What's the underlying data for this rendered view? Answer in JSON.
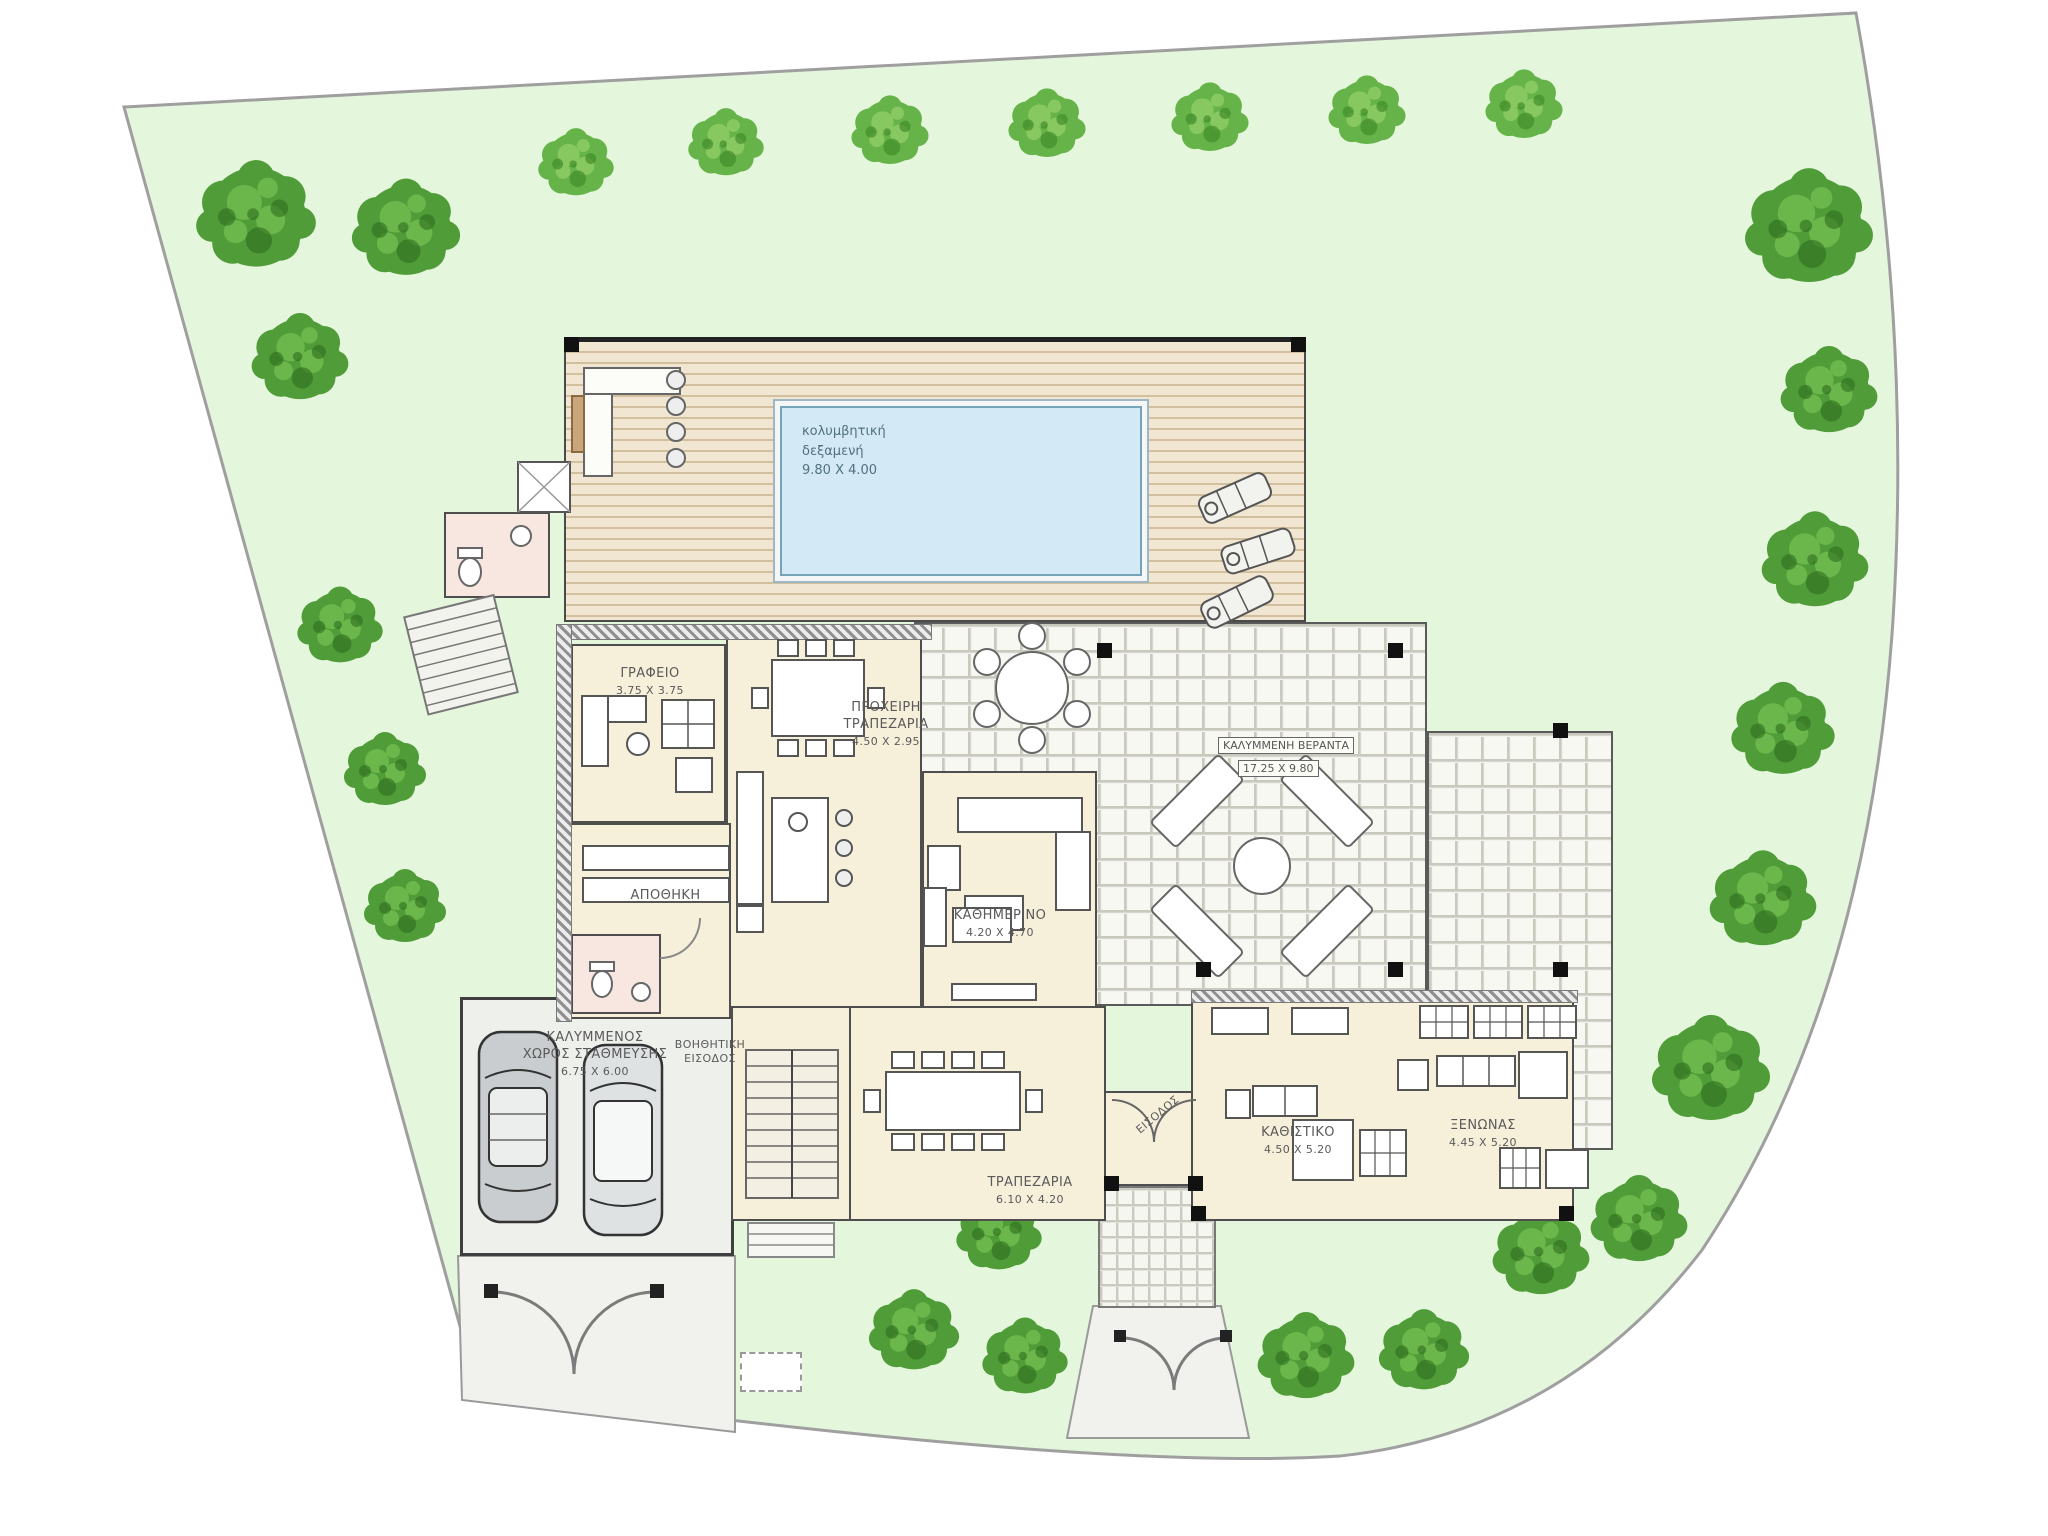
{
  "drawing": {
    "type": "villa-site-plan",
    "style": "architectural top view with garden"
  },
  "colors": {
    "lawn": "#e4f6dc",
    "boundary": "#9f9f9f",
    "deck_wood": "#f0e6d2",
    "deck_plank_line": "#d2bf9e",
    "pool_water": "#d3eaf6",
    "pool_edge": "#76a3b8",
    "veranda_tile": "#f8f8f3",
    "tile_grout": "#c9c9bd",
    "floor_cream": "#f6efda",
    "wall_gray": "#4e4e4e",
    "wet_room_pink": "#f7e7e0",
    "garage_gray": "#eef0ec",
    "tree_green_dark": "#4f9c38",
    "tree_green_light": "#5fae43",
    "label_text": "#5a5a5a"
  },
  "labels": {
    "pool": {
      "line1": "κολυμβητική",
      "line2": "δεξαμενή",
      "dims": "9.80 X 4.00"
    },
    "office": {
      "name": "ΓΡΑΦΕΙΟ",
      "dims": "3.75 X 3.75"
    },
    "informal_dining": {
      "line1": "ΠΡΟΧΕΙΡΗ",
      "line2": "ΤΡΑΠΕΖΑΡΙΑ",
      "dims": "4.50 X 2.95"
    },
    "family_room": {
      "name": "ΚΑΘΗΜΕΡΙΝΟ",
      "dims": "4.20 X 4.70"
    },
    "veranda": {
      "name": "ΚΑΛΥΜΜΕΝΗ ΒΕΡΑΝΤΑ",
      "dims": "17.25 X 9.80"
    },
    "storage": {
      "name": "ΑΠΟΘΗΚΗ"
    },
    "garage": {
      "line1": "ΚΑΛΥΜΜΕΝΟΣ",
      "line2": "ΧΩΡΟΣ ΣΤΑΘΜΕΥΣΗΣ",
      "dims": "6.75 X 6.00"
    },
    "aux_entrance": {
      "line1": "ΒΟΗΘΗΤΙΚΗ",
      "line2": "ΕΙΣΟΔΟΣ"
    },
    "dining": {
      "name": "ΤΡΑΠΕΖΑΡΙΑ",
      "dims": "6.10 X 4.20"
    },
    "entrance": {
      "name": "ΕΙΣΟΔΟΣ"
    },
    "sitting": {
      "name": "ΚΑΘΙΣΤΙΚΟ",
      "dims": "4.50 X 5.20"
    },
    "guest": {
      "name": "ΞΕΝΩΝΑΣ",
      "dims": "4.45 X 5.20"
    }
  }
}
